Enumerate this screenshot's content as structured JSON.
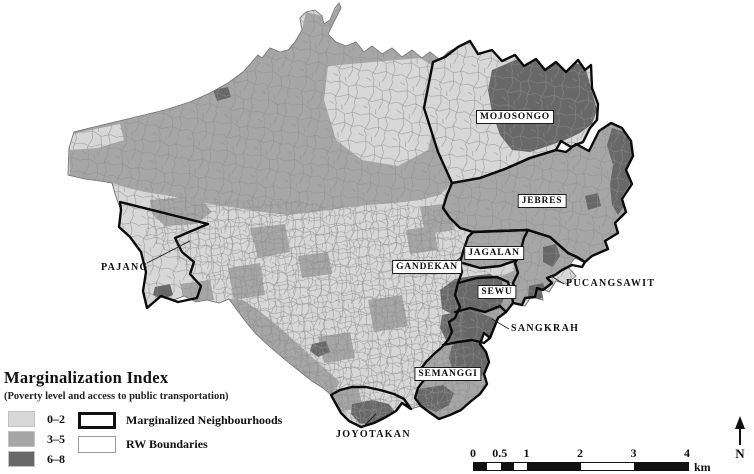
{
  "map": {
    "region_name": "city RW choropleth",
    "labels": [
      {
        "text": "MOJOSONGO",
        "boxed": true
      },
      {
        "text": "JEBRES",
        "boxed": true
      },
      {
        "text": "JAGALAN",
        "boxed": true
      },
      {
        "text": "GANDEKAN",
        "boxed": true
      },
      {
        "text": "SEWU",
        "boxed": true
      },
      {
        "text": "SEMANGGI",
        "boxed": true
      },
      {
        "text": "PUCANGSAWIT",
        "boxed": false
      },
      {
        "text": "SANGKRAH",
        "boxed": false
      },
      {
        "text": "JOYOTAKAN",
        "boxed": false
      },
      {
        "text": "PAJANG",
        "boxed": false
      }
    ]
  },
  "legend": {
    "title": "Marginalization Index",
    "subtitle": "(Poverty level and access to public transportation)",
    "classes": [
      {
        "label": "0–2",
        "color": "#d7d7d7"
      },
      {
        "label": "3–5",
        "color": "#a6a6a6"
      },
      {
        "label": "6–8",
        "color": "#686868"
      }
    ],
    "boundary_items": [
      {
        "label": "Marginalized Neighbourhoods",
        "style": "thick-black-outline"
      },
      {
        "label": "RW Boundaries",
        "style": "thin-gray-outline"
      }
    ]
  },
  "scale_bar": {
    "tick_labels": [
      "0",
      "0.5",
      "1",
      "2",
      "3",
      "4"
    ],
    "unit": "km"
  },
  "north_arrow": {
    "label": "N"
  }
}
